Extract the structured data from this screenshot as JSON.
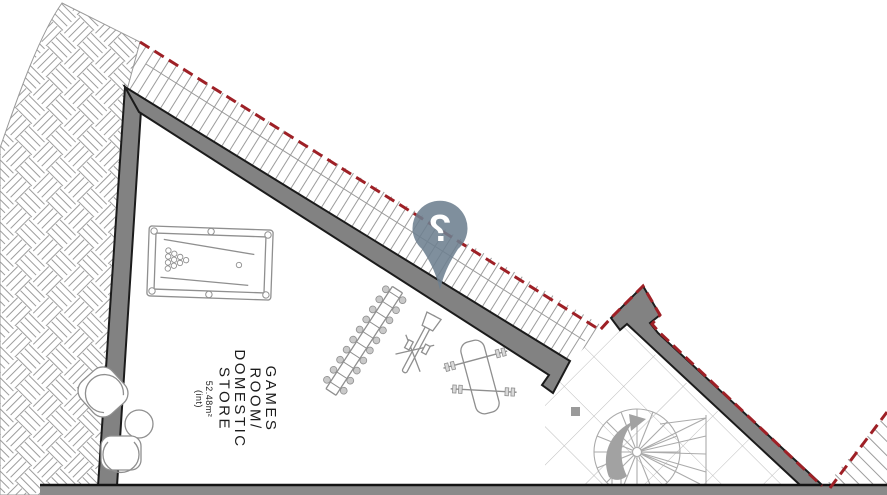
{
  "plan": {
    "type": "architectural-floor-plan",
    "room": {
      "line1": "GAMES",
      "line2": "ROOM/",
      "line3": "DOMESTIC",
      "line4": "STORE",
      "area": "52.48m²",
      "area_note": "(int)"
    },
    "marker": {
      "icon": "question-mark-pin",
      "glyph": "?",
      "color": "#6d8090"
    },
    "colors": {
      "wall_fill": "#828282",
      "wall_outline": "#1b1b1b",
      "boundary_red": "#9e2026",
      "hatch_line": "#9c9c9c",
      "tile_line": "#bbbbbb",
      "furniture_line": "#8f8f8f",
      "stair_line": "#ababab",
      "bottom_band": "#8a8a8a"
    }
  }
}
